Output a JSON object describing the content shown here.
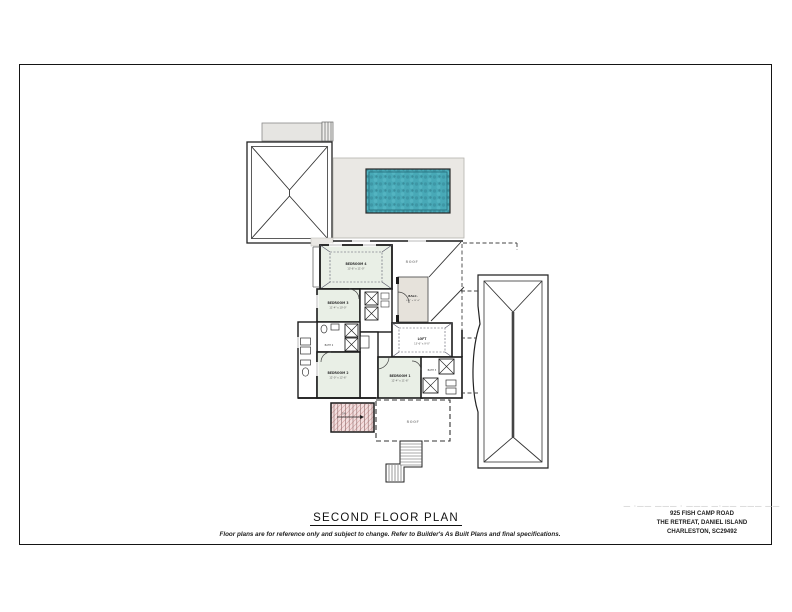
{
  "page": {
    "title": "SECOND FLOOR PLAN",
    "disclaimer": "Floor plans are for reference only and subject to change.  Refer to Builder's As Built Plans and final specifications."
  },
  "title_block": {
    "redacted_name": "— ·—— ——— · ——— —·—— ——— ——",
    "address_line1": "925 FISH CAMP ROAD",
    "address_line2": "THE RETREAT, DANIEL ISLAND",
    "address_line3": "CHARLESTON, SC29492"
  },
  "plan": {
    "labels": {
      "bedroom4": {
        "name": "BEDROOM 4",
        "dim": "13'-6\" x 11'-0\""
      },
      "bedroom3": {
        "name": "BEDROOM 3",
        "dim": "11'-4\" x 10'-0\""
      },
      "bedroom2": {
        "name": "BEDROOM 2",
        "dim": "12'-0\" x 12'-6\""
      },
      "bedroom1": {
        "name": "BEDROOM 1",
        "dim": "12'-4\" x 11'-6\""
      },
      "loft": {
        "name": "LOFT",
        "dim": "13'-6\" x 9'-0\""
      },
      "balcony": {
        "name": "BALC.",
        "dim": "6'-0\" x 12'-6\""
      },
      "bath2": "BATH 2",
      "bath3": "BATH 3",
      "roof_upper": "ROOF",
      "roof_lower": "ROOF",
      "stair_direction": "DN"
    },
    "colors": {
      "pool_water": "#48a9b7",
      "deck": "#eae8e4",
      "room_tint": "#e9efe6",
      "balcony_tint": "#e6e2db",
      "stair_tint": "#f3e0e0",
      "wall": "#1b1b1b"
    }
  }
}
